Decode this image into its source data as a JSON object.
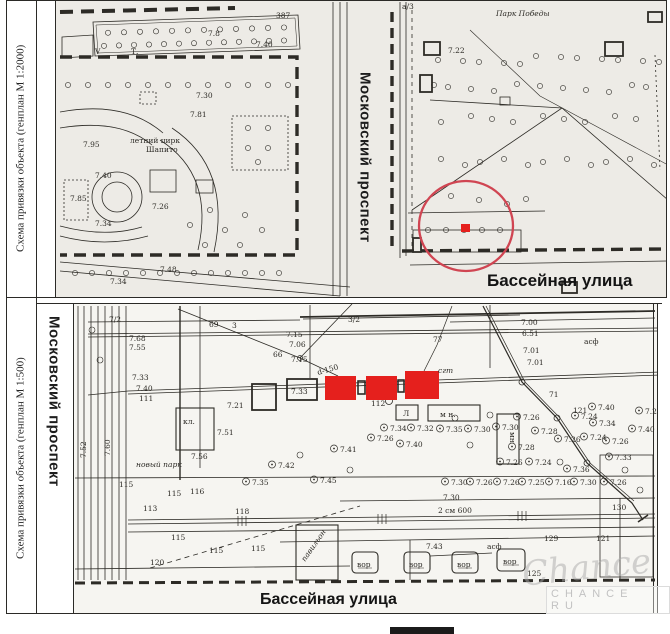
{
  "colors": {
    "highlight_red": "#e5201d",
    "annotation_circle_red": "#d04552",
    "map_ink": "#2d2b26",
    "watermark_gray": "#c2c2c2"
  },
  "panel_top": {
    "caption": "Схема привязки объекта   (генплан М 1:2000)",
    "street_vertical": "Московский проспект",
    "street_horizontal": "Бассейная улица",
    "map_labels": [
      {
        "x": 276,
        "y": 18,
        "t": "387"
      },
      {
        "x": 208,
        "y": 36,
        "t": "7.8"
      },
      {
        "x": 256,
        "y": 47,
        "t": "7.40"
      },
      {
        "x": 95,
        "y": 54,
        "t": "V",
        "size": 10
      },
      {
        "x": 131,
        "y": 54,
        "t": "Т.",
        "size": 10
      },
      {
        "x": 196,
        "y": 98,
        "t": "7.30"
      },
      {
        "x": 190,
        "y": 117,
        "t": "7.81"
      },
      {
        "x": 83,
        "y": 147,
        "t": "7.95"
      },
      {
        "x": 130,
        "y": 143,
        "t": "летний цирк",
        "size": 6.5
      },
      {
        "x": 146,
        "y": 152,
        "t": "Шапито",
        "size": 6.5
      },
      {
        "x": 95,
        "y": 178,
        "t": "7.40"
      },
      {
        "x": 70,
        "y": 201,
        "t": "7.85"
      },
      {
        "x": 152,
        "y": 209,
        "t": "7.26"
      },
      {
        "x": 95,
        "y": 226,
        "t": "7.34"
      },
      {
        "x": 110,
        "y": 284,
        "t": "7.34",
        "size": 6.5
      },
      {
        "x": 160,
        "y": 272,
        "t": "7.48",
        "size": 6.5
      },
      {
        "x": 448,
        "y": 53,
        "t": "7.22"
      },
      {
        "x": 496,
        "y": 16,
        "t": "Парк Победы",
        "size": 9,
        "italic": true
      },
      {
        "x": 402,
        "y": 9,
        "t": "а/3"
      }
    ]
  },
  "panel_bottom": {
    "caption": "Схема привязки объекта   (генплан М 1:500)",
    "street_vertical": "Московский проспект",
    "street_horizontal": "Бассейная улица",
    "map_labels": [
      {
        "x": 109,
        "y": 322,
        "t": "7/2"
      },
      {
        "x": 129,
        "y": 341,
        "t": "7.68"
      },
      {
        "x": 129,
        "y": 350,
        "t": "7.55"
      },
      {
        "x": 209,
        "y": 327,
        "t": "69",
        "size": 9
      },
      {
        "x": 232,
        "y": 328,
        "t": "3"
      },
      {
        "x": 273,
        "y": 357,
        "t": "66",
        "size": 9
      },
      {
        "x": 286,
        "y": 337,
        "t": "7.15"
      },
      {
        "x": 289,
        "y": 347,
        "t": "7.06"
      },
      {
        "x": 291,
        "y": 362,
        "t": "7.15"
      },
      {
        "x": 318,
        "y": 375,
        "t": "d-150",
        "rotate": -16
      },
      {
        "x": 348,
        "y": 322,
        "t": "3/2"
      },
      {
        "x": 433,
        "y": 342,
        "t": "77",
        "size": 9
      },
      {
        "x": 438,
        "y": 373,
        "t": "сгт",
        "size": 6,
        "italic": true
      },
      {
        "x": 521,
        "y": 325,
        "t": "7.00"
      },
      {
        "x": 522,
        "y": 336,
        "t": "6.51"
      },
      {
        "x": 523,
        "y": 353,
        "t": "7.01"
      },
      {
        "x": 527,
        "y": 365,
        "t": "7.01"
      },
      {
        "x": 584,
        "y": 344,
        "t": "асф",
        "size": 7.5
      },
      {
        "x": 132,
        "y": 380,
        "t": "7.33"
      },
      {
        "x": 136,
        "y": 391,
        "t": "7.40"
      },
      {
        "x": 139,
        "y": 401,
        "t": "111"
      },
      {
        "x": 371,
        "y": 406,
        "t": "112"
      },
      {
        "x": 291,
        "y": 394,
        "t": "7.33",
        "size": 5.5
      },
      {
        "x": 227,
        "y": 408,
        "t": "7.21"
      },
      {
        "x": 183,
        "y": 424,
        "t": "кл."
      },
      {
        "x": 217,
        "y": 435,
        "t": "7.51"
      },
      {
        "x": 191,
        "y": 459,
        "t": "7.56"
      },
      {
        "x": 136,
        "y": 467,
        "t": "новый парк",
        "size": 7,
        "italic": true
      },
      {
        "x": 440,
        "y": 417,
        "t": "м н.",
        "size": 7
      },
      {
        "x": 403,
        "y": 416,
        "t": "Л",
        "size": 7
      },
      {
        "x": 510,
        "y": 432,
        "t": "мн",
        "rotate": 90,
        "size": 7
      },
      {
        "x": 549,
        "y": 397,
        "t": "71"
      },
      {
        "x": 573,
        "y": 413,
        "t": "121"
      },
      {
        "x": 598,
        "y": 410,
        "t": "7.40",
        "tree": true
      },
      {
        "x": 581,
        "y": 419,
        "t": "7.24",
        "tree": true
      },
      {
        "x": 390,
        "y": 431,
        "t": "7.34",
        "tree": true
      },
      {
        "x": 417,
        "y": 431,
        "t": "7.32",
        "tree": true
      },
      {
        "x": 446,
        "y": 432,
        "t": "7.35",
        "tree": true
      },
      {
        "x": 474,
        "y": 432,
        "t": "7.30",
        "tree": true
      },
      {
        "x": 502,
        "y": 430,
        "t": "7.30",
        "tree": true
      },
      {
        "x": 377,
        "y": 441,
        "t": "7.26",
        "tree": true
      },
      {
        "x": 406,
        "y": 447,
        "t": "7.40",
        "tree": true
      },
      {
        "x": 340,
        "y": 452,
        "t": "7.41",
        "tree": true
      },
      {
        "x": 523,
        "y": 420,
        "t": "7.26",
        "tree": true
      },
      {
        "x": 541,
        "y": 434,
        "t": "7.28",
        "tree": true
      },
      {
        "x": 518,
        "y": 450,
        "t": "7.28",
        "tree": true
      },
      {
        "x": 506,
        "y": 465,
        "t": "7.26",
        "tree": true
      },
      {
        "x": 535,
        "y": 465,
        "t": "7.24",
        "tree": true
      },
      {
        "x": 564,
        "y": 442,
        "t": "7.26",
        "tree": true
      },
      {
        "x": 590,
        "y": 440,
        "t": "7.24",
        "tree": true
      },
      {
        "x": 612,
        "y": 444,
        "t": "7.26",
        "tree": true
      },
      {
        "x": 599,
        "y": 426,
        "t": "7.34",
        "tree": true
      },
      {
        "x": 615,
        "y": 460,
        "t": "7.33",
        "tree": true
      },
      {
        "x": 638,
        "y": 432,
        "t": "7.40",
        "tree": true
      },
      {
        "x": 645,
        "y": 414,
        "t": "7.26",
        "tree": true
      },
      {
        "x": 451,
        "y": 485,
        "t": "7.30",
        "tree": true
      },
      {
        "x": 476,
        "y": 485,
        "t": "7.26",
        "tree": true
      },
      {
        "x": 503,
        "y": 485,
        "t": "7.26",
        "tree": true
      },
      {
        "x": 528,
        "y": 485,
        "t": "7.25",
        "tree": true
      },
      {
        "x": 555,
        "y": 485,
        "t": "7.16",
        "tree": true
      },
      {
        "x": 580,
        "y": 485,
        "t": "7.30",
        "tree": true
      },
      {
        "x": 610,
        "y": 485,
        "t": "7.26",
        "tree": true
      },
      {
        "x": 278,
        "y": 468,
        "t": "7.42",
        "tree": true
      },
      {
        "x": 252,
        "y": 485,
        "t": "7.35",
        "tree": true
      },
      {
        "x": 320,
        "y": 483,
        "t": "7.45",
        "tree": true
      },
      {
        "x": 573,
        "y": 472,
        "t": "7.36",
        "tree": true
      },
      {
        "x": 443,
        "y": 500,
        "t": "7.30"
      },
      {
        "x": 438,
        "y": 513,
        "t": "2 см 600",
        "size": 9
      },
      {
        "x": 612,
        "y": 510,
        "t": "130",
        "size": 8
      },
      {
        "x": 544,
        "y": 541,
        "t": "129"
      },
      {
        "x": 596,
        "y": 541,
        "t": "121"
      },
      {
        "x": 527,
        "y": 576,
        "t": "125"
      },
      {
        "x": 426,
        "y": 549,
        "t": "7.43"
      },
      {
        "x": 487,
        "y": 549,
        "t": "асф",
        "size": 6.5
      },
      {
        "x": 119,
        "y": 487,
        "t": "115",
        "size": 6.5
      },
      {
        "x": 143,
        "y": 511,
        "t": "113",
        "size": 6.5
      },
      {
        "x": 167,
        "y": 496,
        "t": "115",
        "size": 6.5
      },
      {
        "x": 190,
        "y": 494,
        "t": "116",
        "size": 6.5
      },
      {
        "x": 235,
        "y": 514,
        "t": "118",
        "size": 6.5
      },
      {
        "x": 171,
        "y": 540,
        "t": "115",
        "size": 6.5
      },
      {
        "x": 209,
        "y": 553,
        "t": "115",
        "size": 6.5
      },
      {
        "x": 251,
        "y": 551,
        "t": "115",
        "size": 6.5
      },
      {
        "x": 150,
        "y": 565,
        "t": "120",
        "size": 6.5
      },
      {
        "x": 86,
        "y": 458,
        "t": "7.52",
        "rotate": -90,
        "size": 6.5
      },
      {
        "x": 110,
        "y": 456,
        "t": "7.60",
        "rotate": -90,
        "size": 6.5
      },
      {
        "x": 357,
        "y": 567,
        "t": "вор",
        "size": 5.5
      },
      {
        "x": 409,
        "y": 567,
        "t": "вор",
        "size": 5.5
      },
      {
        "x": 457,
        "y": 567,
        "t": "вор",
        "size": 5.5
      },
      {
        "x": 503,
        "y": 564,
        "t": "вор",
        "size": 5.5
      },
      {
        "x": 305,
        "y": 562,
        "t": "павильон",
        "rotate": -55,
        "size": 6,
        "italic": true
      }
    ]
  },
  "watermark": {
    "script": "Chance",
    "caption": "CHANCE RU"
  }
}
